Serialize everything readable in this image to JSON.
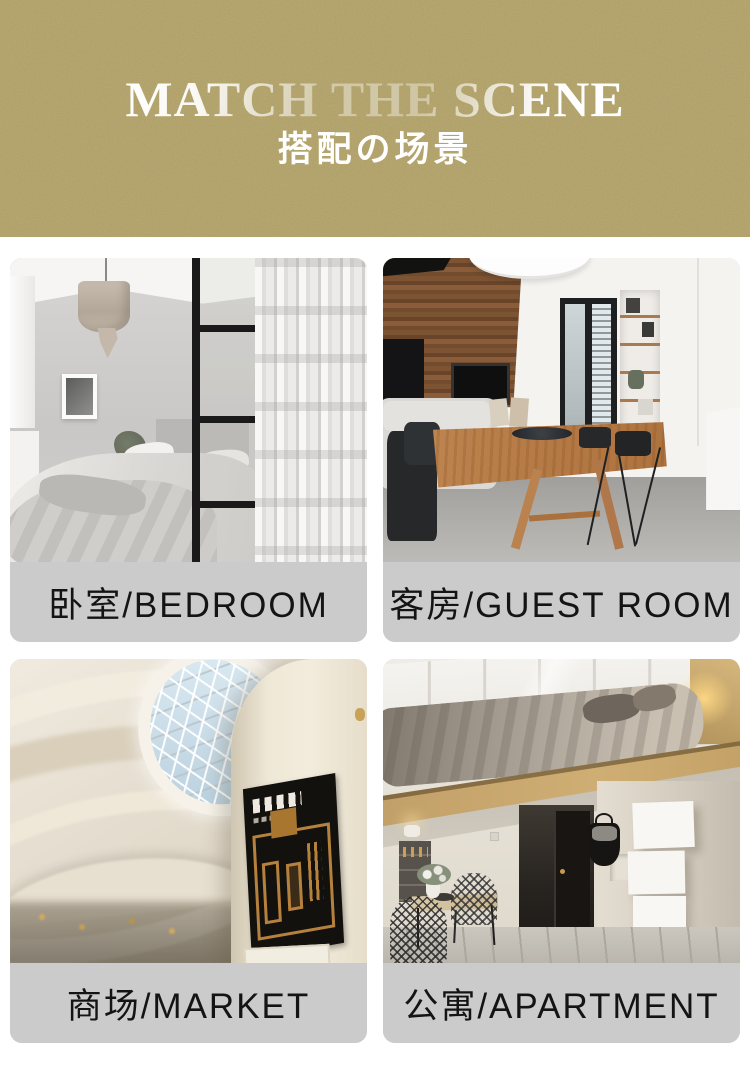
{
  "banner": {
    "title": "MATCH THE SCENE",
    "subtitle": "搭配の场景",
    "background_color": "#b2a164",
    "title_color": "#ffffff"
  },
  "cards": [
    {
      "scene": "bedroom",
      "label": "卧室/BEDROOM",
      "label_zh": "卧室",
      "label_en": "BEDROOM"
    },
    {
      "scene": "guest-room",
      "label": "客房/GUEST ROOM",
      "label_zh": "客房",
      "label_en": "GUEST ROOM"
    },
    {
      "scene": "market",
      "label": "商场/MARKET",
      "label_zh": "商场",
      "label_en": "MARKET"
    },
    {
      "scene": "apartment",
      "label": "公寓/APARTMENT",
      "label_zh": "公寓",
      "label_en": "APARTMENT"
    }
  ],
  "colors": {
    "banner_gold": "#b2a164",
    "label_bar_gray": "#cbcbcb",
    "label_text": "#141414",
    "page_background": "#ffffff"
  }
}
